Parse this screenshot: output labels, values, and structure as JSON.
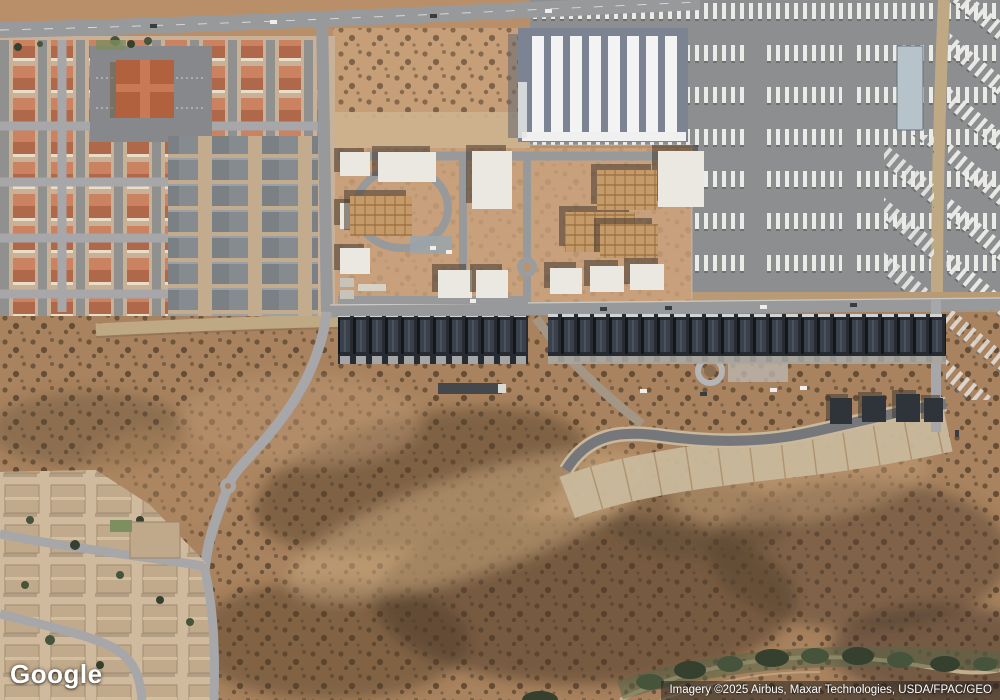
{
  "map": {
    "provider_logo": "Google",
    "attribution": "Imagery ©2025 Airbus, Maxar Technologies, USDA/FPAC/GEO",
    "view": "satellite"
  },
  "colors": {
    "desert_base": "#b98f6a",
    "scrub_base": "#a9835f",
    "vacant_lot": "#c69e78",
    "construction_dirt": "#c8a17c",
    "neighborhood_nw": "#c9b197",
    "neighborhood_sw": "#cfba9e",
    "asphalt_lot": "#8d8e90",
    "warehouse_gray": "#7c8493",
    "warehouse_white": "#f2f3f2",
    "roof_red": "#c07a5b",
    "roof_gray": "#868b90",
    "townhouse_dark": "#262b31",
    "church_roof": "#b2613f",
    "vegetation": "#45523b",
    "road": "#98999b"
  }
}
